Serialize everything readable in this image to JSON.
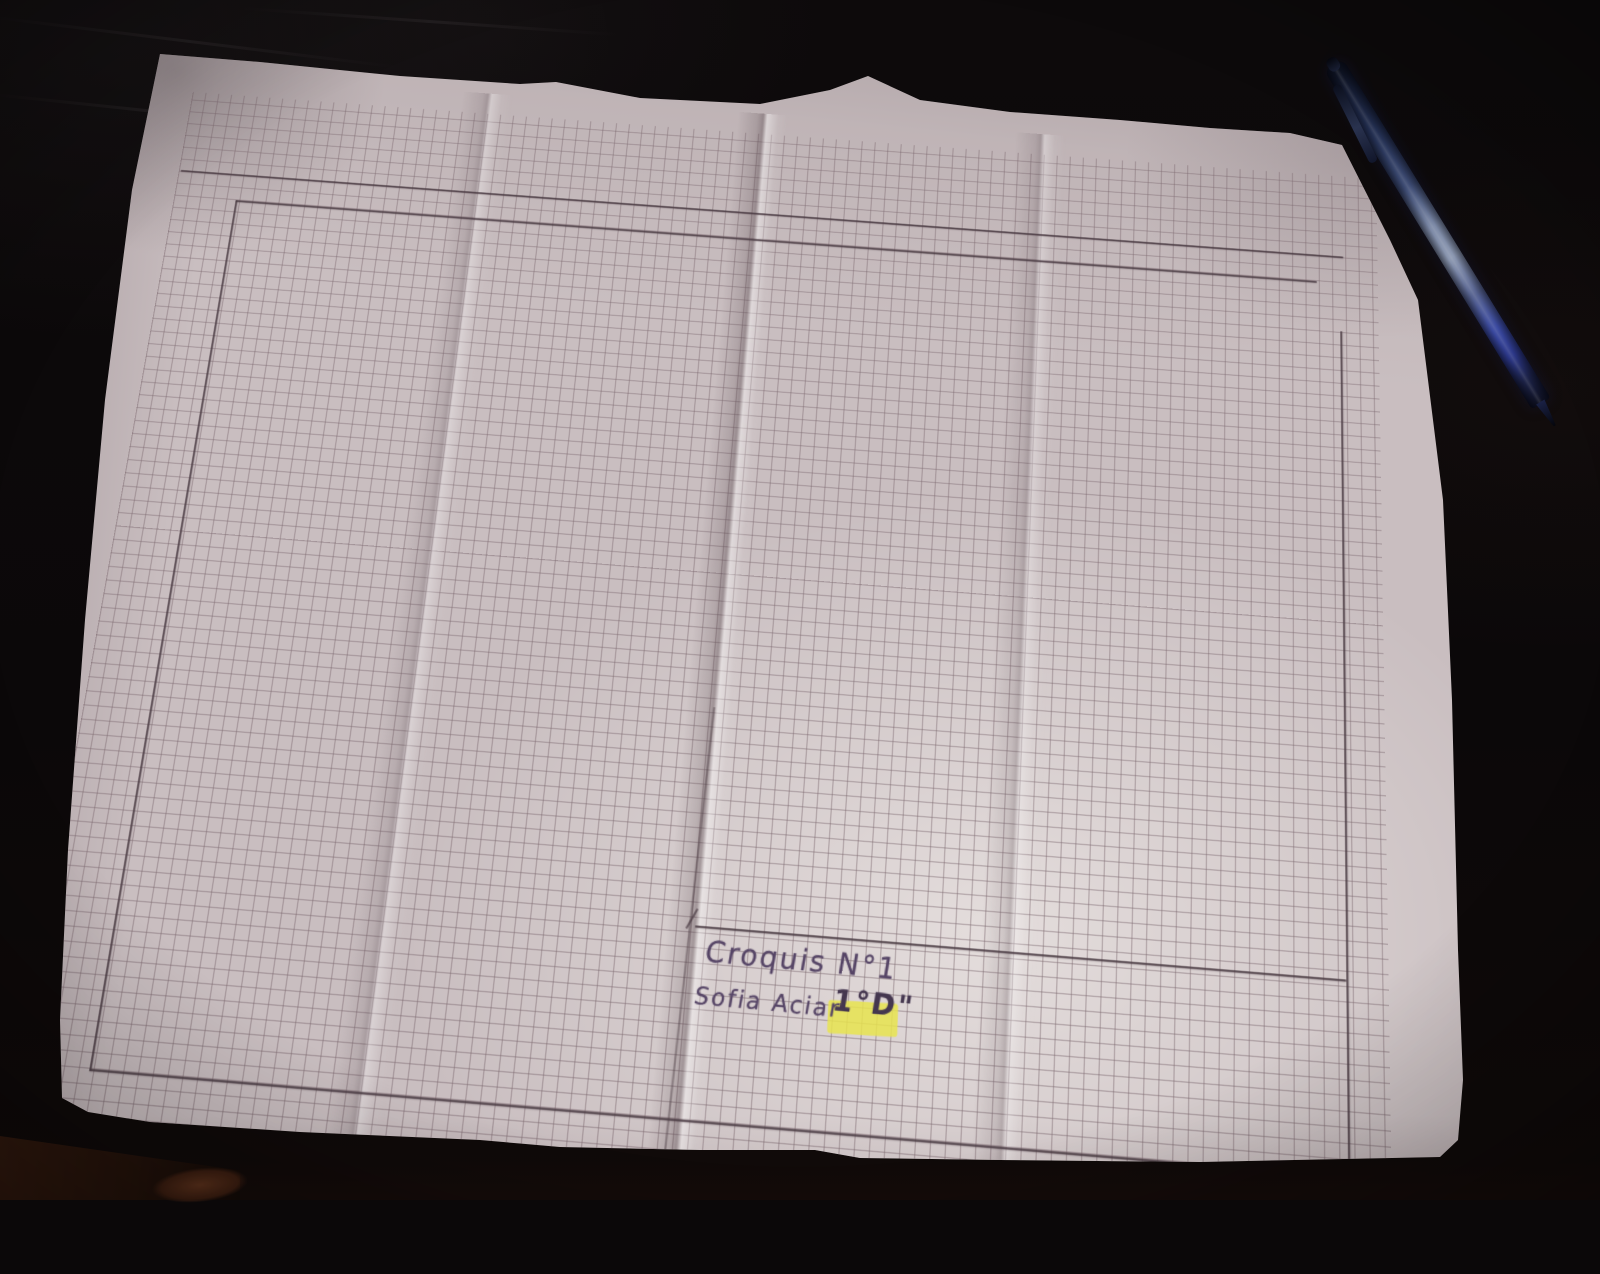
{
  "scene": {
    "label": "folded sheet of squared graph paper on a dark desk with a blue ballpoint pen"
  },
  "paper": {
    "kind": "quadrille-grid-sheet",
    "title_block": {
      "line1": "Croquis N°1",
      "line2": "Sofia Aciar",
      "grade": "1°D\"",
      "grade_highlight_color": "#e8e44f"
    },
    "colors": {
      "paper": "#c9bec0",
      "grid_line": "#7a666d",
      "pencil_line": "#4a3b43",
      "handwriting_ink": "#564566"
    },
    "folds": 3
  },
  "pen": {
    "kind": "blue-ballpoint-pen",
    "color": "#2e3a8c"
  },
  "desk": {
    "color": "#0b0809",
    "wood_accent_color": "#4e2717"
  }
}
